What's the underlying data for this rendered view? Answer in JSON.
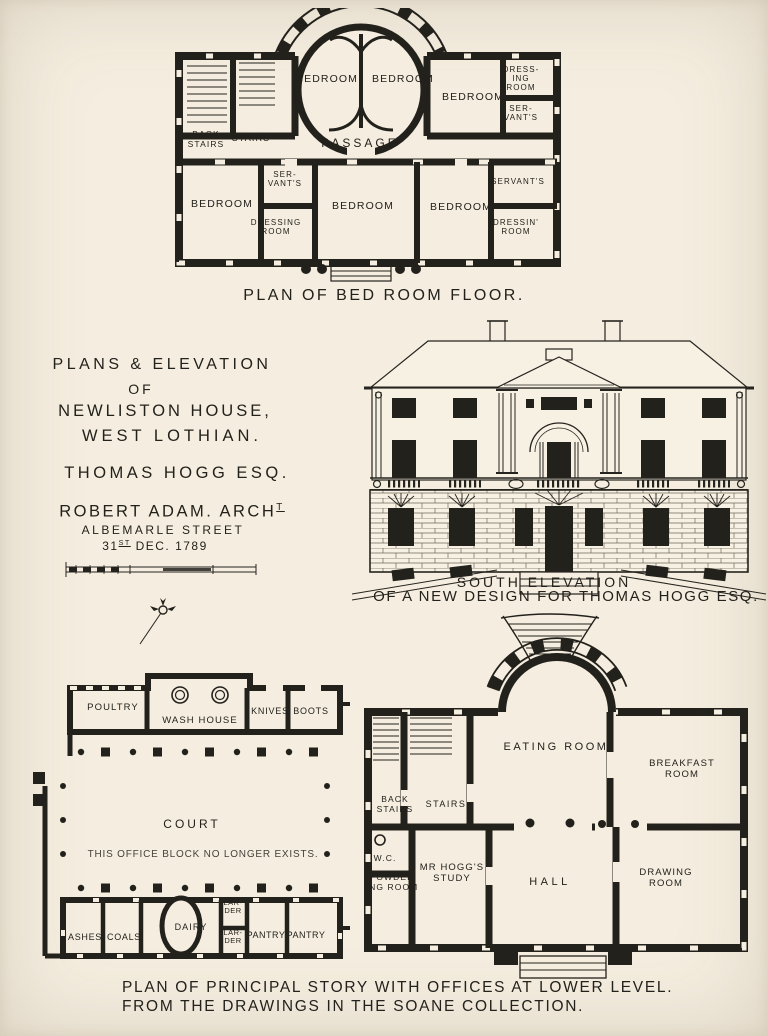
{
  "colors": {
    "paper": "#f5eee0",
    "ink": "#23211c"
  },
  "title_block": {
    "line1": "PLANS & ELEVATION",
    "line2": "OF",
    "line3": "NEWLISTON HOUSE,",
    "line4": "WEST LOTHIAN.",
    "client": "THOMAS HOGG ESQ.",
    "architect": "ROBERT ADAM. ARCH",
    "architect_sup": "T",
    "address": "ALBEMARLE STREET",
    "date_day": "31",
    "date_ordinal": "ST",
    "date_rest": " DEC. 1789"
  },
  "bedroom_plan": {
    "caption": "PLAN OF BED ROOM FLOOR.",
    "rooms": {
      "back_stairs": "BACK STAIRS",
      "stairs": "STAIRS",
      "bedroom_circle_left": "BEDROOM",
      "bedroom_circle_right": "BEDROOM",
      "bedroom_east": "BEDROOM",
      "dressing_room_ne": "DRESS- ING ROOM",
      "servants_ne": "SER- VANT'S",
      "passage": "PASSAGE",
      "bedroom_sw": "BEDROOM",
      "servants_south": "SER- VANT'S",
      "dressing_room_south": "DRESSING ROOM",
      "bedroom_south_center": "BEDROOM",
      "bedroom_south_east": "BEDROOM",
      "servants_se": "SERVANT'S",
      "dressing_room_se": "DRESSIN' ROOM"
    }
  },
  "elevation": {
    "caption_line1": "SOUTH ELEVATION",
    "caption_line2": "OF A NEW DESIGN FOR THOMAS HOGG ESQ."
  },
  "office_plan": {
    "note": "THIS OFFICE BLOCK NO LONGER EXISTS.",
    "rooms": {
      "poultry": "POULTRY",
      "wash_house": "WASH HOUSE",
      "knives": "KNIVES",
      "boots": "BOOTS",
      "court": "COURT",
      "ashes": "ASHES",
      "coals": "COALS",
      "dairy": "DAIRY",
      "larder_upper": "LAR- DER",
      "larder_lower": "LAR- DER",
      "pantry_left": "PANTRY",
      "pantry_right": "PANTRY"
    }
  },
  "principal_plan": {
    "rooms": {
      "eating_room": "EATING ROOM",
      "breakfast_room": "BREAKFAST ROOM",
      "back_stairs": "BACK STAIRS",
      "stairs": "STAIRS",
      "wc": "W.C.",
      "powdering_room": "POWDER ING ROOM",
      "study": "MR HOGG'S STUDY",
      "hall": "HALL",
      "drawing_room": "DRAWING ROOM"
    }
  },
  "footer": {
    "line1": "PLAN OF PRINCIPAL STORY WITH OFFICES AT LOWER LEVEL.",
    "line2": "FROM THE DRAWINGS IN THE SOANE COLLECTION."
  }
}
